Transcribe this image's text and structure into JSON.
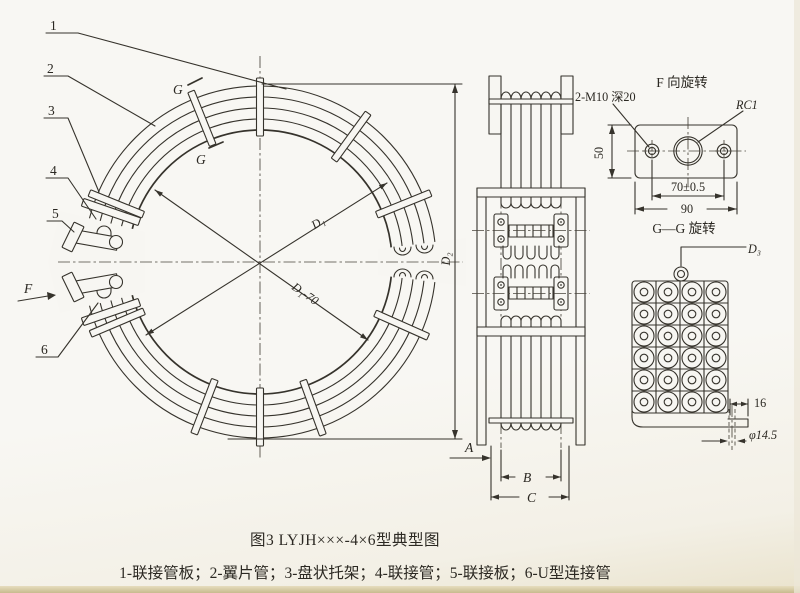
{
  "colors": {
    "ink": "#36332c",
    "paper": "#f7f6f2"
  },
  "caption": {
    "title": "图3 LYJH×××-4×6型典型图",
    "legend": "1-联接管板；2-翼片管；3-盘状托架；4-联接管；5-联接板；6-U型连接管"
  },
  "main_view": {
    "part_labels": {
      "p1": "1",
      "p2": "2",
      "p3": "3",
      "p4": "4",
      "p5": "5",
      "p6": "6"
    },
    "view_f": "F",
    "section_g_top": "G",
    "section_g_bottom": "G",
    "dim_d1": "D₁",
    "dim_d2": "D₂",
    "dim_d1_70": "D₁-70"
  },
  "side_view": {
    "dim_a": "A",
    "dim_b": "B",
    "dim_c": "C"
  },
  "f_view": {
    "title": "F 向旋转",
    "thread_note": "2-M10 深20",
    "pipe_thread": "RC1",
    "dim_height": "50",
    "dim_hole_span": "70±0.5",
    "dim_width": "90"
  },
  "gg_view": {
    "title": "G—G 旋转",
    "dim_d3": "D₃",
    "dim_tab": "16",
    "dim_hole": "φ14.5"
  }
}
